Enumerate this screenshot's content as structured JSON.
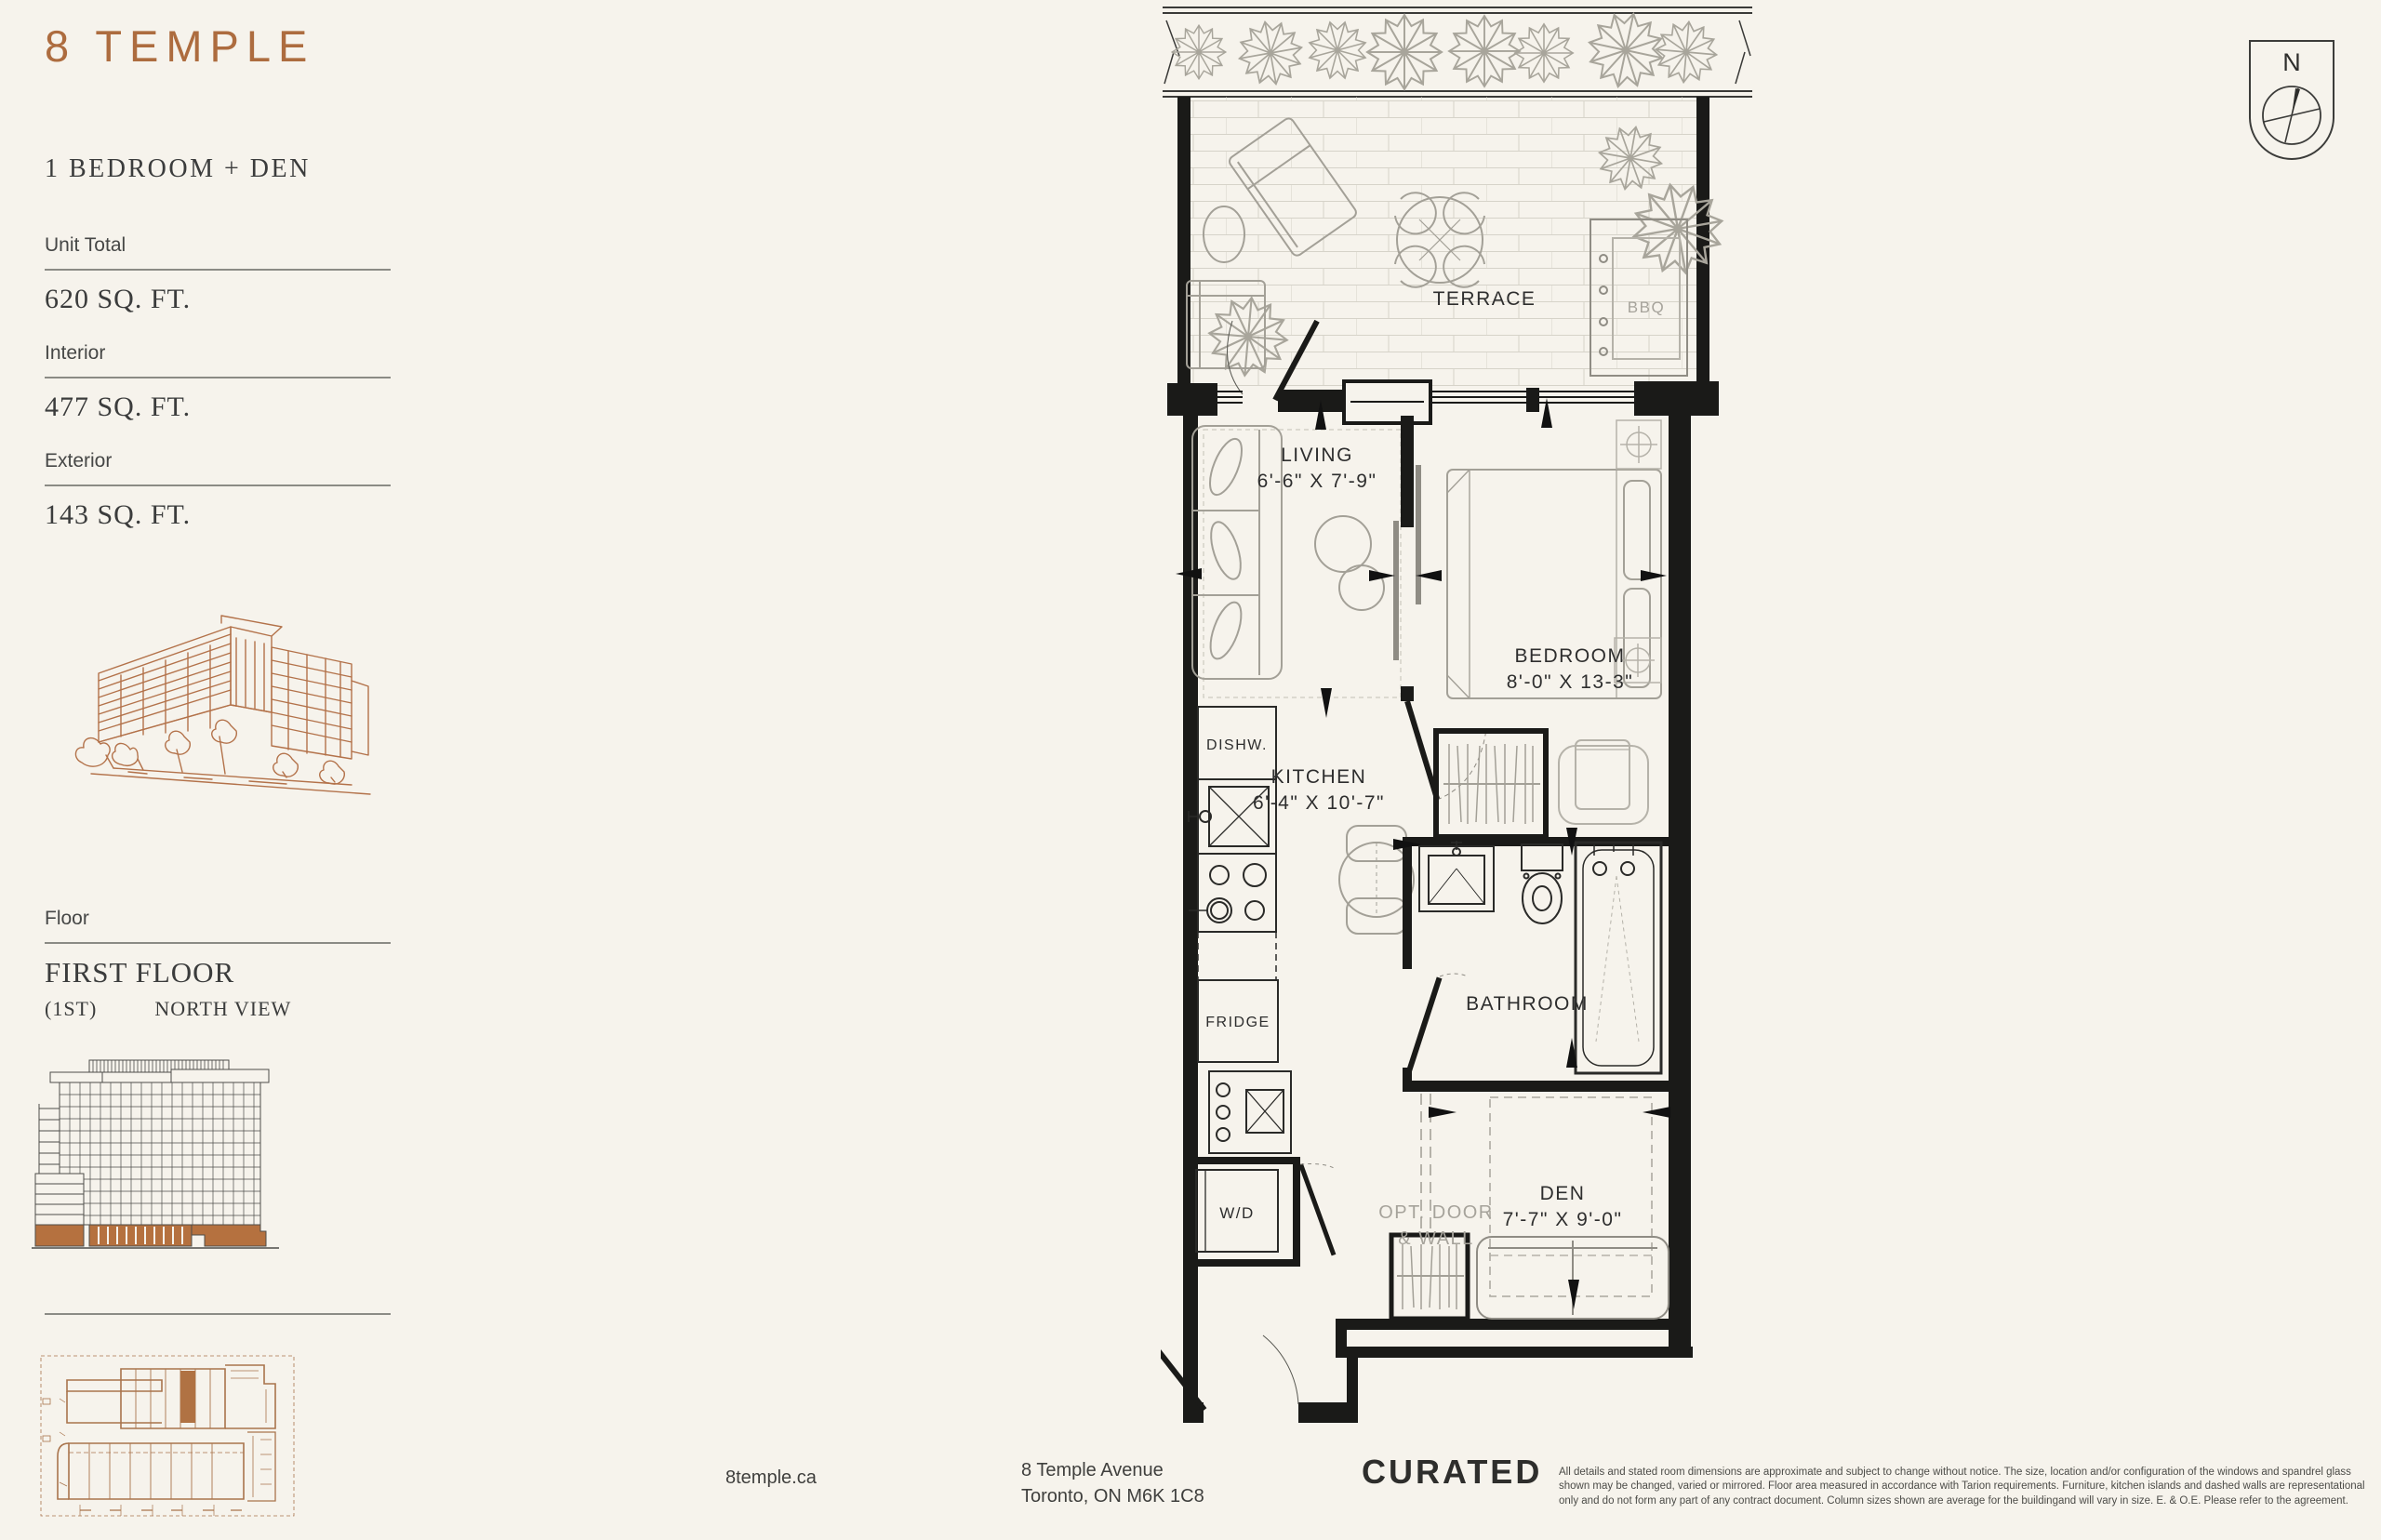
{
  "header": {
    "logo": "8 TEMPLE"
  },
  "sidebar": {
    "unit_type": "1 BEDROOM + DEN",
    "unit_total_label": "Unit Total",
    "unit_total_value": "620 SQ. FT.",
    "interior_label": "Interior",
    "interior_value": "477 SQ. FT.",
    "exterior_label": "Exterior",
    "exterior_value": "143 SQ. FT.",
    "floor_label": "Floor",
    "floor_name": "FIRST FLOOR",
    "floor_number": "(1ST)",
    "floor_view": "NORTH VIEW"
  },
  "plan": {
    "terrace_label": "TERRACE",
    "bbq_label": "BBQ",
    "living_label": "LIVING",
    "living_dims": "6'-6\" X 7'-9\"",
    "kitchen_label": "KITCHEN",
    "kitchen_dims": "6'-4\" X 10'-7\"",
    "bedroom_label": "BEDROOM",
    "bedroom_dims": "8'-0\" X 13-3\"",
    "bathroom_label": "BATHROOM",
    "den_label": "DEN",
    "den_dims": "7'-7\" X 9'-0\"",
    "dishwasher_label": "DISHW.",
    "fridge_label": "FRIDGE",
    "washer_dryer_label": "W/D",
    "opt_door_line1": "OPT. DOOR",
    "opt_door_line2": "& WALL"
  },
  "compass": {
    "north": "N"
  },
  "footer": {
    "website": "8temple.ca",
    "address_line1": "8 Temple Avenue",
    "address_line2": "Toronto, ON M6K 1C8",
    "brand": "CURATED",
    "disclaimer": "All details and stated room dimensions are approximate and subject to change without notice. The size, location and/or configuration of the windows and spandrel glass shown may be changed, varied or mirrored. Floor area measured in accordance with Tarion requirements. Furniture, kitchen islands and dashed walls are representational only and do not form any part of any contract document. Column sizes shown are average for the buildingand will vary in size. E. & O.E. Please refer to the agreement."
  },
  "colors": {
    "copper": "#ad6c3f",
    "ink": "#1b1b1b",
    "cream": "#f6f3ec"
  }
}
